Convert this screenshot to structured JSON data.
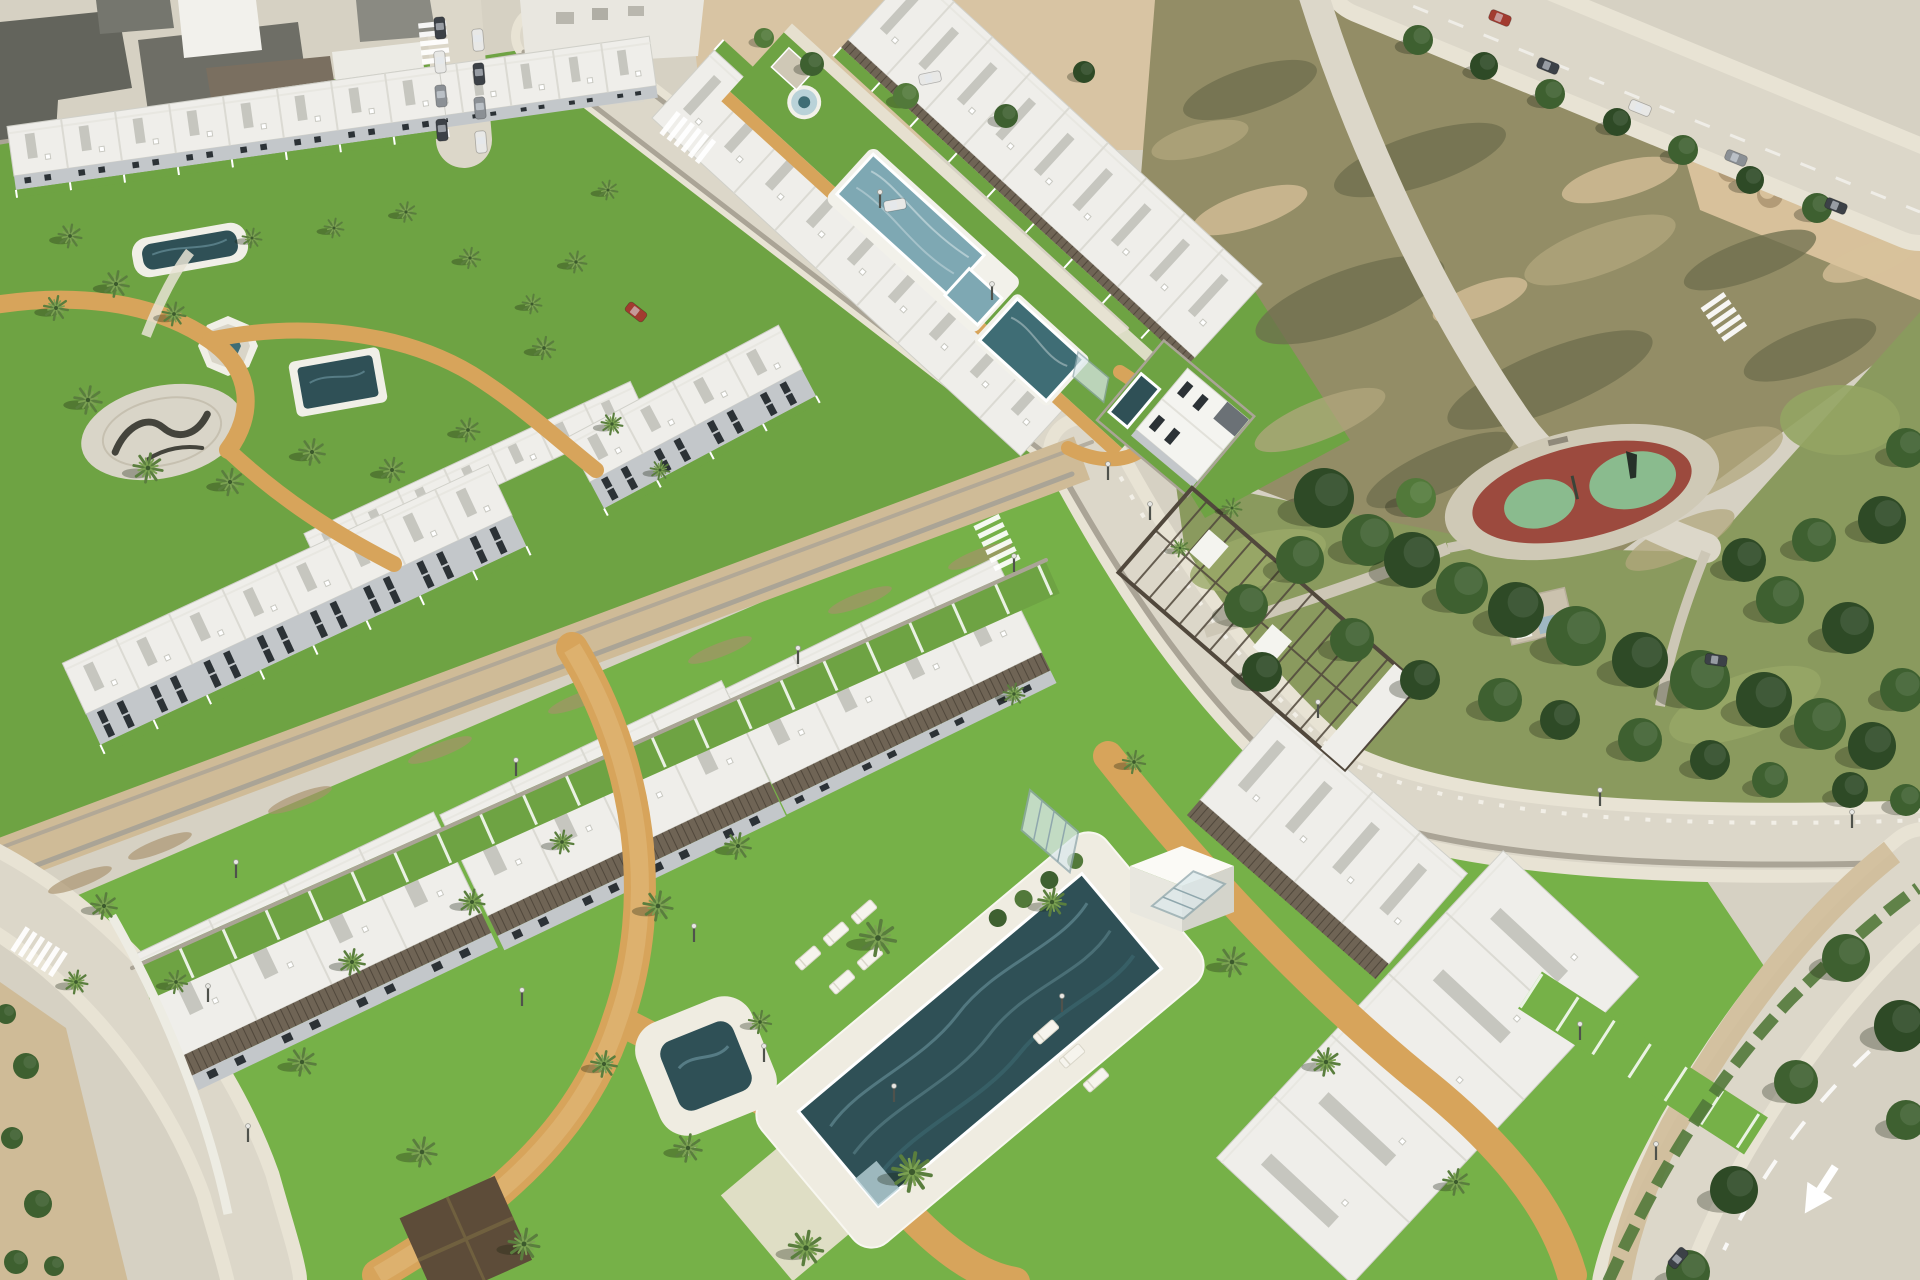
{
  "meta": {
    "title": "Aerial 3D render of a coastal residential development with white townhouses, communal pools, lawns, palm trees, a park with playground, roads and a vacant lot"
  },
  "colors": {
    "base": "#d6d1c3",
    "roadLight": "#dcd7c9",
    "sidewalk": "#e8e3d4",
    "dirt": "#cfbb97",
    "dirtDark": "#b29b77",
    "sand": "#d8c19b",
    "scrub": "#938d66",
    "scrubDark": "#6e6e4d",
    "scrubLight": "#b1a77e",
    "lawn": "#6ea343",
    "lawnBright": "#76b148",
    "parkGrass": "#8a9a5e",
    "treeDark": "#2e4a26",
    "tree": "#3e6030",
    "treeLight": "#52793a",
    "palm": "#5a7e3e",
    "palmDark": "#3c5a2d",
    "palmLight": "#7ba152",
    "poolDark": "#2f5056",
    "pool": "#3f6d75",
    "poolLight": "#7ea8b3",
    "poolPale": "#b9d2d8",
    "roofWhite": "#efeeea",
    "wallShade": "#c3c7ca",
    "windowDark": "#2c3236",
    "pergola": "#6f6455",
    "pergolaDark": "#51483c",
    "stoneWall": "#aaa496",
    "pathTan": "#d7a45b",
    "plaza": "#d9d5c8",
    "playRed": "#9c4a3e",
    "mint": "#8abb8e",
    "carRed": "#a23b30",
    "carDark": "#3c4147",
    "carWhite": "#e8e8e6",
    "carGray": "#8b9095"
  },
  "scene": {
    "rows": [
      {
        "x": 270,
        "y": 140,
        "rot": -8,
        "len": 390,
        "depth": 50,
        "units": 8,
        "facadeH": 12,
        "windowRows": 1
      },
      {
        "x": 14,
        "y": 176,
        "rot": -8,
        "len": 436,
        "depth": 50,
        "units": 8,
        "facadeH": 14,
        "windowRows": 1,
        "yardH": 8
      },
      {
        "x": 320,
        "y": 568,
        "rot": -25,
        "len": 360,
        "depth": 38,
        "units": 7
      },
      {
        "x": 86,
        "y": 714,
        "rot": -25,
        "len": 470,
        "depth": 56,
        "units": 8,
        "facadeH": 34,
        "windowRows": 2,
        "yardH": 10
      },
      {
        "x": 590,
        "y": 482,
        "rot": -28,
        "len": 240,
        "depth": 50,
        "units": 4,
        "facadeH": 30,
        "windowRows": 2,
        "yardH": 8
      },
      {
        "x": 652,
        "y": 118,
        "rot": 42.5,
        "len": 500,
        "depth": 92,
        "units": 9,
        "yardH": 14,
        "yardSide": "top"
      },
      {
        "x": 848,
        "y": 40,
        "rot": 42.5,
        "len": 470,
        "depth": 100,
        "units": 9,
        "pergH": 10,
        "yardH": 12
      },
      {
        "x": 182,
        "y": 1056,
        "rot": -25.5,
        "len": 332,
        "depth": 112,
        "units": 4,
        "pergH": 22,
        "facadeH": 16,
        "windowRows": 1
      },
      {
        "x": 488,
        "y": 916,
        "rot": -25.5,
        "len": 312,
        "depth": 112,
        "units": 4,
        "pergH": 22,
        "facadeH": 16,
        "windowRows": 1
      },
      {
        "x": 772,
        "y": 784,
        "rot": -26,
        "len": 300,
        "depth": 106,
        "units": 4,
        "pergH": 20,
        "facadeH": 14,
        "windowRows": 1
      },
      {
        "x": 1200,
        "y": 800,
        "rot": 41,
        "len": 250,
        "depth": 120,
        "units": 4,
        "pergH": 20
      },
      {
        "x": 1352,
        "y": 1284,
        "rot": -47,
        "len": 420,
        "depth": 185,
        "units": 5
      }
    ],
    "urbanBuildings": [
      {
        "pts": "0,22 118,10 132,88 58,100 56,132 0,140",
        "fill": "#63645c"
      },
      {
        "pts": "138,40 298,22 312,120 152,140",
        "fill": "#6e6e66"
      },
      {
        "pts": "178,0 256,0 262,50 184,58",
        "fill": "#f2f1ec"
      },
      {
        "pts": "206,68 330,56 342,130 218,142",
        "fill": "#7a6f60"
      },
      {
        "pts": "332,52 420,42 430,106 340,116",
        "fill": "#ecebe5"
      },
      {
        "pts": "356,0 430,0 436,36 360,42",
        "fill": "#8a8a82"
      },
      {
        "pts": "520,0 704,0 698,56 526,66",
        "fill": "#e9e7e0"
      },
      {
        "pts": "540,66 638,58 644,102 546,110",
        "fill": "#d9d6cc"
      },
      {
        "pts": "96,0 170,0 174,28 100,34",
        "fill": "#75766e"
      }
    ],
    "palms": [
      [
        70,
        236,
        0.72
      ],
      [
        56,
        308,
        0.75
      ],
      [
        116,
        284,
        0.8
      ],
      [
        174,
        314,
        0.72
      ],
      [
        88,
        400,
        0.85
      ],
      [
        148,
        468,
        0.9
      ],
      [
        230,
        482,
        0.82
      ],
      [
        312,
        452,
        0.8
      ],
      [
        392,
        470,
        0.76
      ],
      [
        468,
        430,
        0.72
      ],
      [
        252,
        238,
        0.6
      ],
      [
        334,
        228,
        0.6
      ],
      [
        406,
        212,
        0.62
      ],
      [
        470,
        258,
        0.64
      ],
      [
        532,
        304,
        0.6
      ],
      [
        608,
        190,
        0.6
      ],
      [
        576,
        262,
        0.66
      ],
      [
        544,
        348,
        0.7
      ],
      [
        612,
        424,
        0.66
      ],
      [
        660,
        470,
        0.6
      ],
      [
        1232,
        508,
        0.6
      ],
      [
        1180,
        548,
        0.55
      ],
      [
        878,
        938,
        1.1
      ],
      [
        912,
        1172,
        1.2
      ],
      [
        806,
        1248,
        1.05
      ],
      [
        658,
        906,
        0.9
      ],
      [
        738,
        846,
        0.8
      ],
      [
        1052,
        902,
        0.85
      ],
      [
        1232,
        962,
        0.9
      ],
      [
        1326,
        1062,
        0.85
      ],
      [
        562,
        842,
        0.72
      ],
      [
        472,
        902,
        0.78
      ],
      [
        352,
        962,
        0.8
      ],
      [
        302,
        1062,
        0.85
      ],
      [
        422,
        1152,
        0.9
      ],
      [
        524,
        1244,
        0.95
      ],
      [
        1456,
        1182,
        0.8
      ],
      [
        176,
        982,
        0.7
      ],
      [
        1134,
        762,
        0.7
      ],
      [
        1014,
        694,
        0.66
      ],
      [
        604,
        1064,
        0.8,
        1
      ],
      [
        688,
        1148,
        0.85,
        1
      ],
      [
        760,
        1022,
        0.7,
        1
      ],
      [
        104,
        906,
        0.8
      ],
      [
        76,
        982,
        0.72
      ]
    ],
    "trees": [
      [
        1324,
        498,
        30,
        "treeDark"
      ],
      [
        1368,
        540,
        26,
        "tree"
      ],
      [
        1300,
        560,
        24,
        "tree"
      ],
      [
        1412,
        560,
        28,
        "treeDark"
      ],
      [
        1462,
        588,
        26,
        "tree"
      ],
      [
        1516,
        610,
        28,
        "treeDark"
      ],
      [
        1576,
        636,
        30,
        "tree"
      ],
      [
        1640,
        660,
        28,
        "treeDark"
      ],
      [
        1700,
        680,
        30,
        "tree"
      ],
      [
        1764,
        700,
        28,
        "treeDark"
      ],
      [
        1820,
        724,
        26,
        "tree"
      ],
      [
        1872,
        746,
        24,
        "treeDark"
      ],
      [
        1902,
        690,
        22,
        "tree"
      ],
      [
        1848,
        628,
        26,
        "treeDark"
      ],
      [
        1780,
        600,
        24,
        "tree"
      ],
      [
        1744,
        560,
        22,
        "treeDark"
      ],
      [
        1814,
        540,
        22,
        "tree"
      ],
      [
        1882,
        520,
        24,
        "treeDark"
      ],
      [
        1906,
        448,
        20,
        "tree"
      ],
      [
        1416,
        498,
        20,
        "treeLight"
      ],
      [
        1246,
        606,
        22,
        "tree"
      ],
      [
        1262,
        672,
        20,
        "treeDark"
      ],
      [
        1352,
        640,
        22,
        "tree"
      ],
      [
        1420,
        680,
        20,
        "treeDark"
      ],
      [
        1500,
        700,
        22,
        "tree"
      ],
      [
        1560,
        720,
        20,
        "treeDark"
      ],
      [
        1640,
        740,
        22,
        "tree"
      ],
      [
        1710,
        760,
        20,
        "treeDark"
      ],
      [
        1770,
        780,
        18,
        "tree"
      ],
      [
        1850,
        790,
        18,
        "treeDark"
      ],
      [
        1906,
        800,
        16,
        "tree"
      ],
      [
        1846,
        958,
        24,
        "tree"
      ],
      [
        1900,
        1026,
        26,
        "treeDark"
      ],
      [
        1796,
        1082,
        22,
        "tree"
      ],
      [
        1734,
        1190,
        24,
        "treeDark"
      ],
      [
        1688,
        1272,
        22,
        "tree"
      ],
      [
        1906,
        1120,
        20,
        "tree"
      ],
      [
        1418,
        40,
        15,
        "tree"
      ],
      [
        1484,
        66,
        14,
        "treeDark"
      ],
      [
        1550,
        94,
        15,
        "tree"
      ],
      [
        1617,
        122,
        14,
        "treeDark"
      ],
      [
        1683,
        150,
        15,
        "tree"
      ],
      [
        1750,
        180,
        14,
        "treeDark"
      ],
      [
        1817,
        208,
        15,
        "tree"
      ],
      [
        812,
        64,
        12,
        "tree"
      ],
      [
        906,
        96,
        13,
        "treeLight"
      ],
      [
        1006,
        116,
        12,
        "tree"
      ],
      [
        1084,
        72,
        11,
        "treeDark"
      ],
      [
        764,
        38,
        10,
        "treeLight"
      ]
    ],
    "bushes": [
      [
        26,
        1066,
        13
      ],
      [
        12,
        1138,
        11
      ],
      [
        38,
        1204,
        14
      ],
      [
        16,
        1262,
        12
      ],
      [
        54,
        1266,
        10
      ],
      [
        6,
        1014,
        10
      ]
    ],
    "cars": [
      [
        440,
        28,
        85,
        "carDark"
      ],
      [
        440,
        62,
        85,
        "carWhite"
      ],
      [
        441,
        96,
        85,
        "carGray"
      ],
      [
        442,
        130,
        85,
        "carDark"
      ],
      [
        478,
        40,
        85,
        "carWhite"
      ],
      [
        479,
        74,
        85,
        "carDark"
      ],
      [
        480,
        108,
        85,
        "carGray"
      ],
      [
        481,
        142,
        85,
        "carWhite"
      ],
      [
        895,
        205,
        -10,
        "carWhite"
      ],
      [
        930,
        78,
        -12,
        "carWhite"
      ],
      [
        636,
        312,
        38,
        "carRed"
      ],
      [
        1500,
        18,
        22,
        "carRed"
      ],
      [
        1548,
        66,
        22,
        "carDark"
      ],
      [
        1640,
        108,
        22,
        "carWhite"
      ],
      [
        1736,
        158,
        22,
        "carGray"
      ],
      [
        1836,
        206,
        22,
        "carDark"
      ],
      [
        1716,
        660,
        8,
        "carDark"
      ],
      [
        1678,
        1258,
        -50,
        "carDark"
      ]
    ],
    "loungers": [
      [
        808,
        958
      ],
      [
        836,
        934
      ],
      [
        864,
        912
      ],
      [
        842,
        982
      ],
      [
        870,
        958
      ],
      [
        1046,
        1032
      ],
      [
        1072,
        1056
      ],
      [
        1096,
        1080
      ]
    ],
    "zebras": [
      {
        "x": 668,
        "y": 122,
        "rot": 38,
        "n": 6
      },
      {
        "x": 986,
        "y": 520,
        "rot": 64,
        "n": 6
      },
      {
        "x": 18,
        "y": 938,
        "rot": 33,
        "n": 6
      },
      {
        "x": 432,
        "y": 22,
        "rot": 84,
        "n": 5
      },
      {
        "x": 1712,
        "y": 300,
        "rot": 55,
        "n": 5
      }
    ],
    "lamps": [
      [
        1150,
        520
      ],
      [
        1318,
        718
      ],
      [
        1600,
        806
      ],
      [
        1852,
        828
      ],
      [
        236,
        878
      ],
      [
        516,
        776
      ],
      [
        798,
        664
      ],
      [
        1014,
        572
      ],
      [
        208,
        1002
      ],
      [
        248,
        1142
      ],
      [
        1108,
        480
      ],
      [
        694,
        942
      ],
      [
        764,
        1062
      ],
      [
        894,
        1102
      ],
      [
        1062,
        1012
      ],
      [
        522,
        1006
      ],
      [
        880,
        208
      ],
      [
        992,
        300
      ],
      [
        1580,
        1040
      ],
      [
        1656,
        1160
      ]
    ],
    "scrubPatches": [
      [
        1250,
        90,
        70,
        22,
        -18,
        "scrubDark"
      ],
      [
        1420,
        160,
        90,
        26,
        -18,
        "scrubDark"
      ],
      [
        1600,
        250,
        80,
        24,
        -20,
        "scrubLight"
      ],
      [
        1350,
        300,
        100,
        30,
        -20,
        "scrubDark"
      ],
      [
        1550,
        380,
        110,
        30,
        -22,
        "scrubDark"
      ],
      [
        1700,
        470,
        90,
        26,
        -24,
        "scrubLight"
      ],
      [
        1250,
        210,
        60,
        18,
        -18,
        "sand"
      ],
      [
        1480,
        300,
        50,
        16,
        -20,
        "sand"
      ],
      [
        1320,
        420,
        70,
        20,
        -22,
        "scrubLight"
      ],
      [
        1620,
        180,
        60,
        18,
        -15,
        "sand"
      ],
      [
        1750,
        260,
        70,
        20,
        -20,
        "scrubDark"
      ],
      [
        1200,
        140,
        50,
        16,
        -15,
        "scrubLight"
      ],
      [
        1440,
        470,
        80,
        22,
        -24,
        "scrubDark"
      ],
      [
        1680,
        540,
        60,
        18,
        -26,
        "scrubLight"
      ],
      [
        1810,
        350,
        70,
        22,
        -20,
        "scrubDark"
      ],
      [
        1870,
        260,
        50,
        16,
        -20,
        "sand"
      ]
    ],
    "mounds": [
      [
        1700,
        110,
        16
      ],
      [
        1740,
        130,
        14
      ],
      [
        1780,
        150,
        15
      ],
      [
        1820,
        170,
        13
      ],
      [
        1860,
        190,
        14
      ],
      [
        1730,
        170,
        12
      ],
      [
        1770,
        195,
        13
      ],
      [
        1850,
        140,
        12
      ],
      [
        1890,
        215,
        12
      ],
      [
        1805,
        120,
        11
      ]
    ],
    "streaks": [
      [
        160,
        846
      ],
      [
        300,
        800
      ],
      [
        440,
        750
      ],
      [
        580,
        700
      ],
      [
        720,
        650
      ],
      [
        860,
        600
      ],
      [
        980,
        556
      ],
      [
        80,
        880
      ]
    ]
  }
}
